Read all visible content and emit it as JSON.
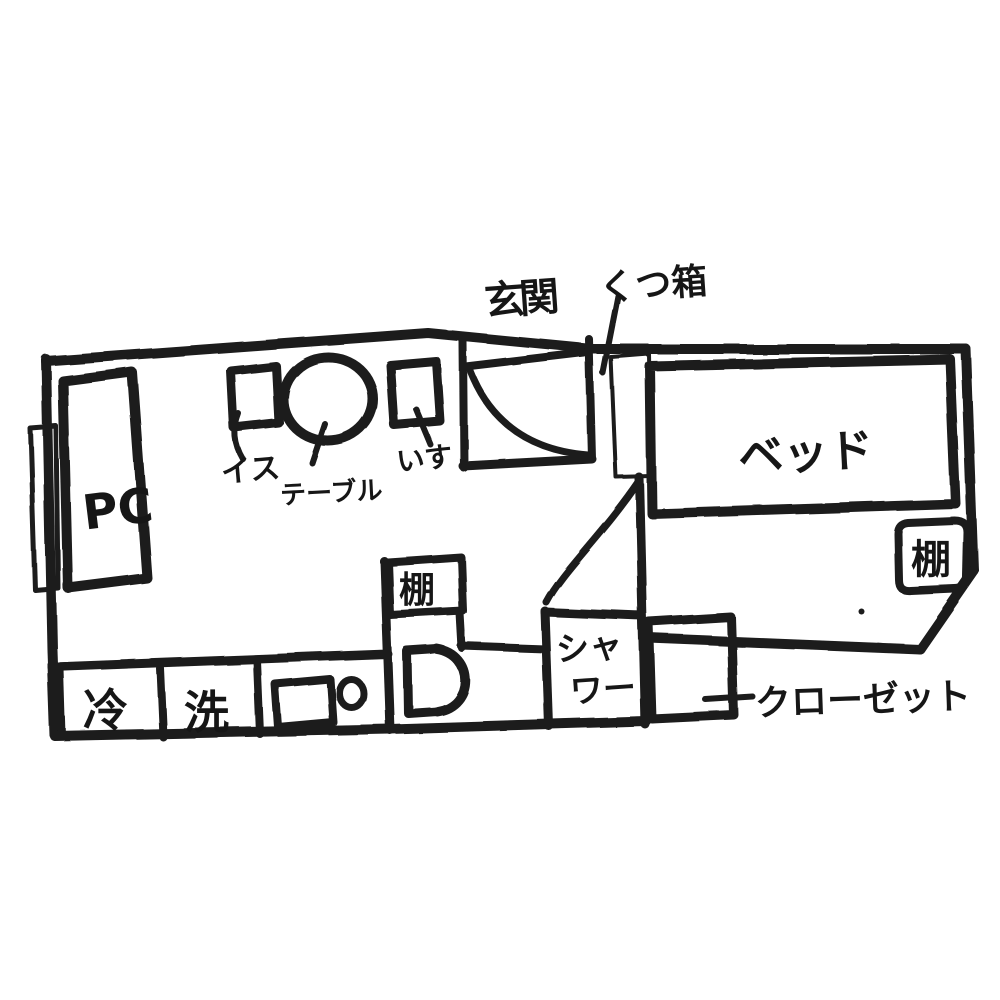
{
  "floorplan": {
    "type": "hand-drawn apartment floor plan sketch",
    "colors": {
      "ink": "#1b1b1b",
      "paper": "#ffffff"
    },
    "labels": {
      "entrance": "玄関",
      "shoe_box": "くつ箱",
      "bed": "ベッド",
      "bedroom_shelf": "棚",
      "toilet_shelf": "棚",
      "pc": "PC",
      "chair_left": "イス",
      "table": "テーブル",
      "chair_right": "いす",
      "fridge": "冷",
      "washer": "洗",
      "shower_line1": "シャ",
      "shower_line2": "ワー",
      "closet": "クローゼット"
    }
  }
}
